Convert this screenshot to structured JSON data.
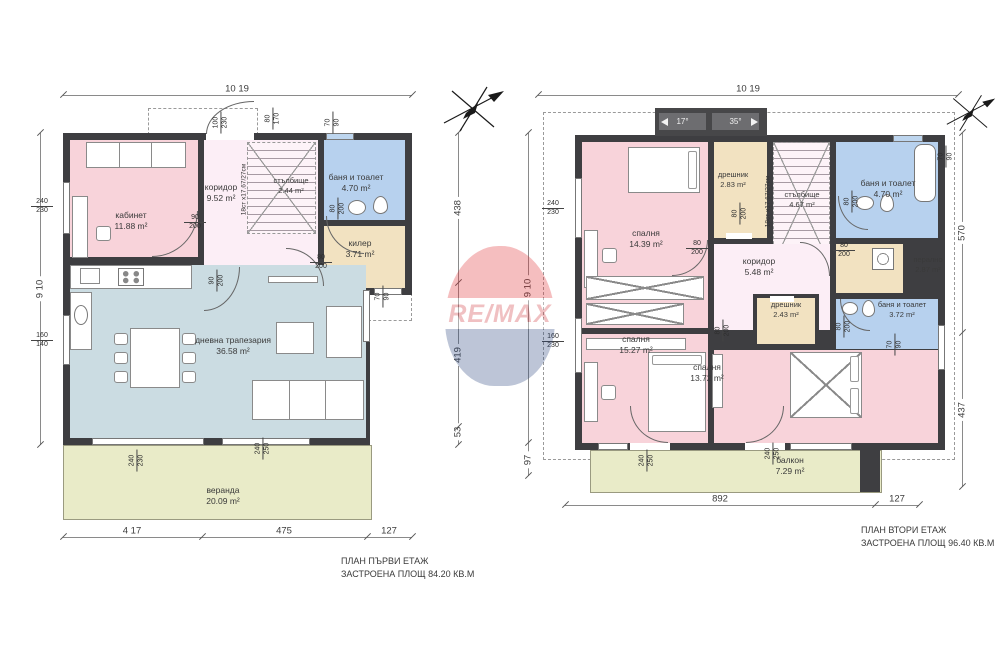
{
  "watermark": {
    "text": "RE/MAX"
  },
  "floor1": {
    "top_dim": "10 19",
    "left_dim": "9 10",
    "right_dims": [
      "438",
      "419",
      "53"
    ],
    "bottom_dims": [
      "4 17",
      "475",
      "127"
    ],
    "caption1": "ПЛАН ПЪРВИ ЕТАЖ",
    "caption2": "ЗАСТРОЕНА ПЛОЩ 84.20 КВ.М",
    "stair_note": "18ст х17.67/27см",
    "rooms": {
      "kabinet": {
        "name": "кабинет",
        "area": "11.88 m²"
      },
      "koridor": {
        "name": "коридор",
        "area": "9.52 m²"
      },
      "stairs": {
        "name": "стълбище",
        "area": "2.44 m²"
      },
      "bath": {
        "name": "баня и тоалет",
        "area": "4.70 m²"
      },
      "kiler": {
        "name": "килер",
        "area": "3.71 m²"
      },
      "living": {
        "name": "дневна трапезария",
        "area": "36.58 m²"
      },
      "veranda": {
        "name": "веранда",
        "area": "20.09 m²"
      }
    },
    "tags": [
      {
        "a": "100",
        "b": "230"
      },
      {
        "a": "80",
        "b": "170"
      },
      {
        "a": "70",
        "b": "90"
      },
      {
        "a": "90",
        "b": "200"
      },
      {
        "a": "80",
        "b": "200"
      },
      {
        "a": "80",
        "b": "200"
      },
      {
        "a": "90",
        "b": "200"
      },
      {
        "a": "70",
        "b": "90"
      },
      {
        "a": "240",
        "b": "230"
      },
      {
        "a": "160",
        "b": "140"
      },
      {
        "a": "240",
        "b": "230"
      },
      {
        "a": "240",
        "b": "250"
      }
    ]
  },
  "floor2": {
    "top_dim": "10 19",
    "left_dim": "9 10",
    "left_dim2": "97",
    "right_dims": [
      "570",
      "437"
    ],
    "bottom_dims": [
      "892",
      "127"
    ],
    "caption1": "ПЛАН ВТОРИ ЕТАЖ",
    "caption2": "ЗАСТРОЕНА ПЛОЩ 96.40 КВ.М",
    "stair_note": "18ст х17.67/27см",
    "roof": {
      "left": "17°",
      "right": "35°"
    },
    "rooms": {
      "bedroom1": {
        "name": "спалня",
        "area": "14.39 m²"
      },
      "dreshnik1": {
        "name": "дрешник",
        "area": "2.83 m²"
      },
      "stairs": {
        "name": "стълбище",
        "area": "4.67 m²"
      },
      "bath1": {
        "name": "баня и тоалет",
        "area": "4.70 m²"
      },
      "laundry": {
        "name": "перално",
        "area": "2.87 m²"
      },
      "koridor": {
        "name": "коридор",
        "area": "5.48 m²"
      },
      "dreshnik2": {
        "name": "дрешник",
        "area": "2.43 m²"
      },
      "bath2": {
        "name": "баня и тоалет",
        "area": "3.72 m²"
      },
      "bedroom2": {
        "name": "спалня",
        "area": "15.27 m²"
      },
      "bedroom3": {
        "name": "спалня",
        "area": "13.72 m²"
      },
      "balkon": {
        "name": "балкон",
        "area": "7.29 m²"
      }
    },
    "tags": [
      {
        "a": "240",
        "b": "230"
      },
      {
        "a": "160",
        "b": "230"
      },
      {
        "a": "80",
        "b": "200"
      },
      {
        "a": "80",
        "b": "200"
      },
      {
        "a": "80",
        "b": "200"
      },
      {
        "a": "80",
        "b": "200"
      },
      {
        "a": "80",
        "b": "200"
      },
      {
        "a": "80",
        "b": "200"
      },
      {
        "a": "240",
        "b": "250"
      },
      {
        "a": "240",
        "b": "250"
      },
      {
        "a": "70",
        "b": "90"
      },
      {
        "a": "70",
        "b": "90"
      }
    ]
  }
}
